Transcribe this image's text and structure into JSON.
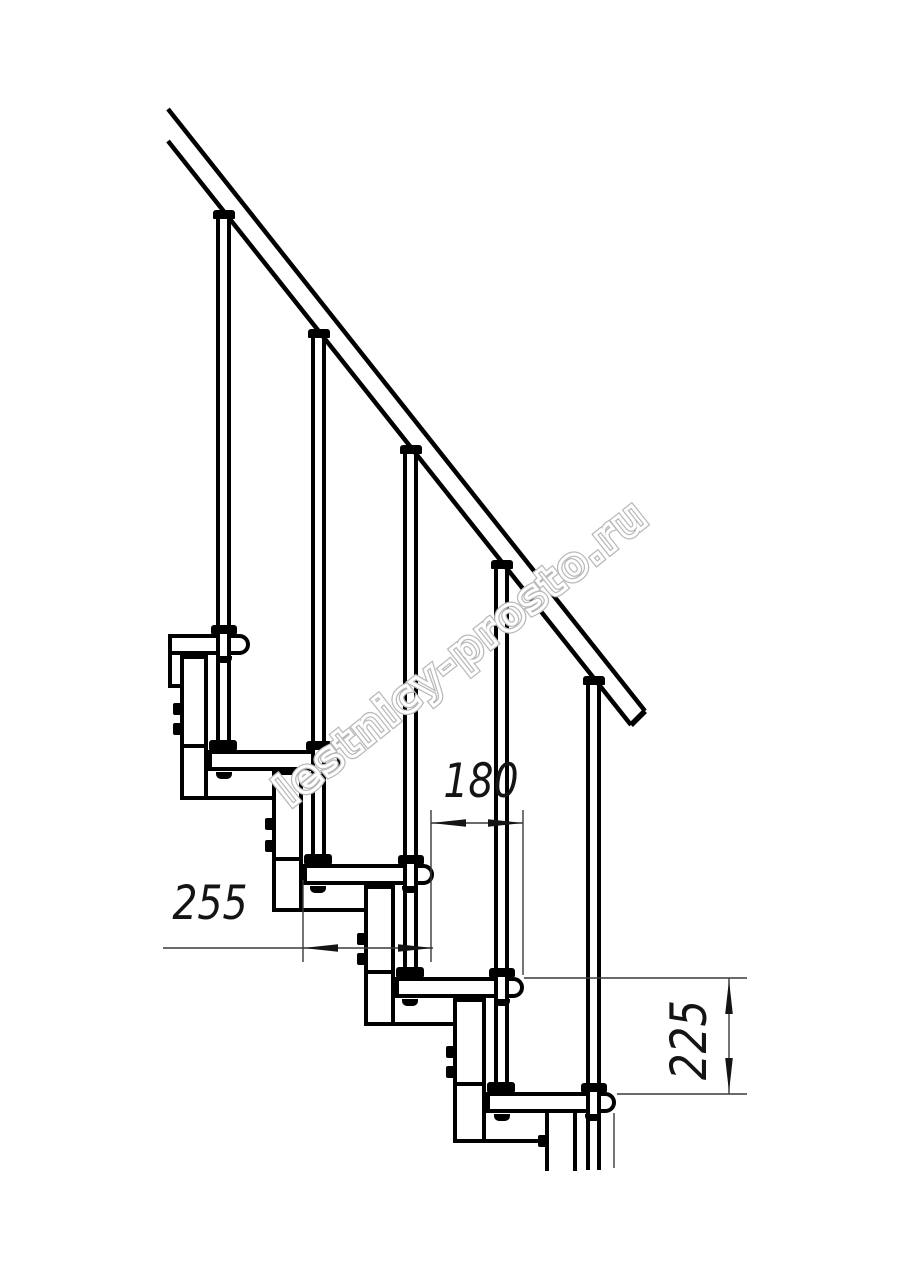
{
  "figure": {
    "subject": "Modular staircase side elevation drawing",
    "treads_visible": 5,
    "balusters_visible": 5,
    "handrail": true
  },
  "dimensions": {
    "run": {
      "value": "180",
      "orientation": "horizontal"
    },
    "depth": {
      "value": "255",
      "orientation": "horizontal"
    },
    "rise": {
      "value": "225",
      "orientation": "vertical"
    }
  },
  "watermark": {
    "text": "lestnicy-prosto.ru"
  },
  "colors": {
    "line": "#000000",
    "dimension_line": "#3a3a3a",
    "watermark_stroke": "#b9b9b9",
    "background": "#ffffff"
  }
}
